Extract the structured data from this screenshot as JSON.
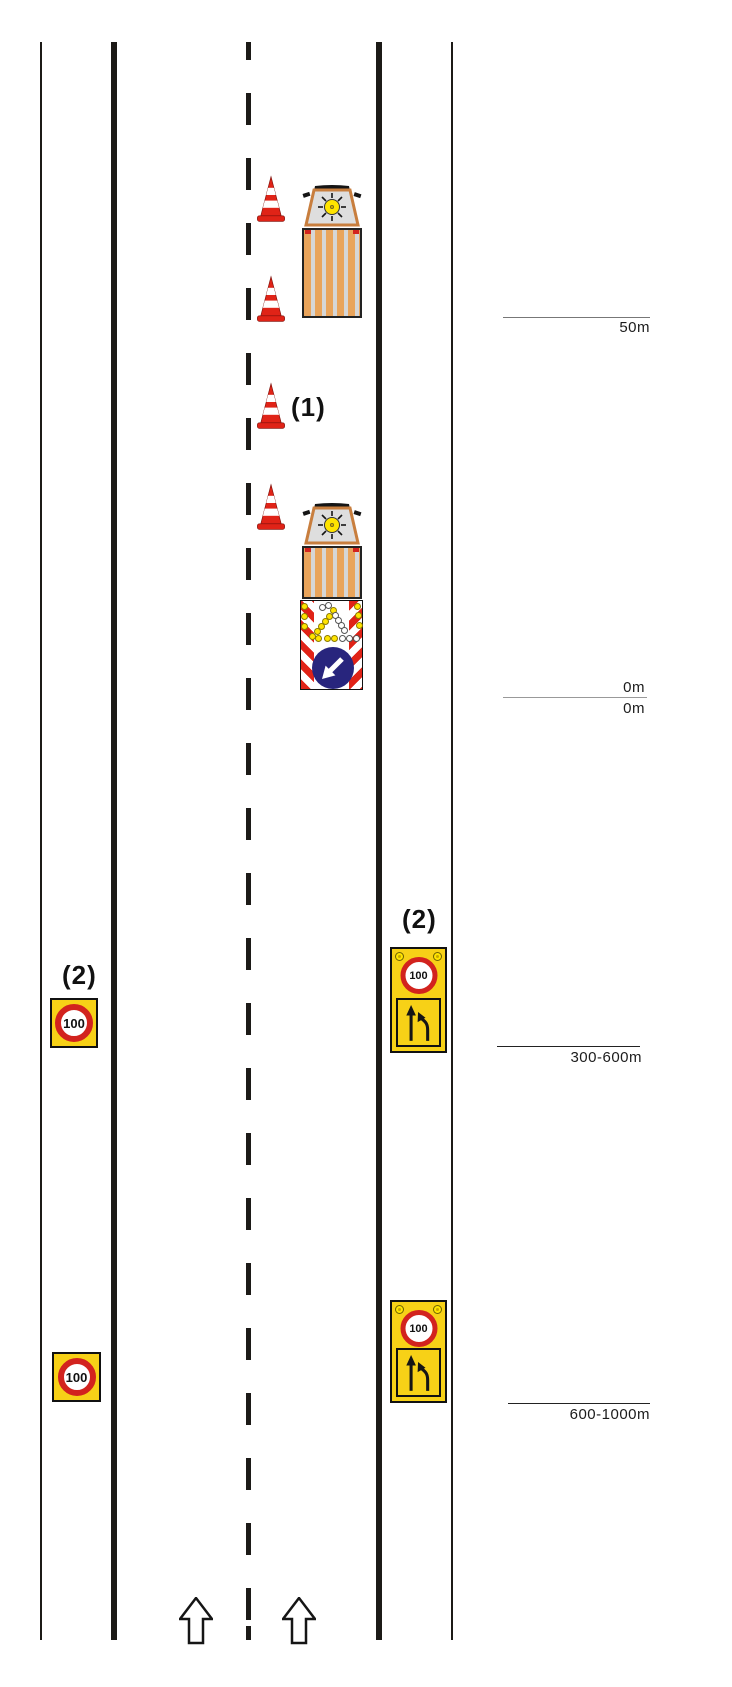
{
  "notes": {
    "cone_row_label": "(1)",
    "left_sign_label": "(2)",
    "right_sign_label": "(2)"
  },
  "distance_markers": {
    "m50": "50m",
    "m0_upper": "0m",
    "m0_lower": "0m",
    "m300_600": "300-600m",
    "m600_1000": "600-1000m"
  },
  "signs": {
    "speed_limit": "100"
  },
  "colors": {
    "cone_red": "#e02317",
    "sign_yellow": "#f7d117",
    "ring_red": "#d2231e",
    "board_blue": "#28257d",
    "truck_orange": "#e9a45b",
    "lamp_yellow": "#ffe400",
    "line_black": "#1c1a17"
  }
}
